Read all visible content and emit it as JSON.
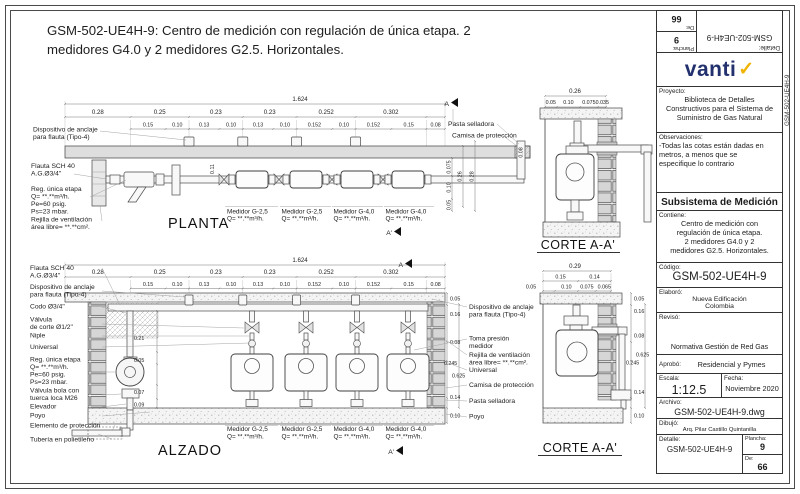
{
  "title": "GSM-502-UE4H-9: Centro de medición con regulación de única etapa.  2 medidores G4.0 y 2 medidores G2.5. Horizontales.",
  "margin_code": "GSM-502-UE4H-9",
  "brand": {
    "name": "vanti",
    "check": "✓",
    "navy": "#22306e",
    "yellow": "#f0b400"
  },
  "tb": {
    "proyecto_label": "Proyecto:",
    "proyecto": "Biblioteca de Detalles\nConstructivos para el Sistema de\nSuministro de Gas Natural",
    "observaciones_label": "Observaciones:",
    "observaciones": "-Todas las cotas están dadas en\nmetros, a menos que se\nespecifique lo contrario",
    "subsistema": "Subsistema de Medición",
    "contiene_label": "Contiene:",
    "contiene": "Centro de medición con\nregulación de única etapa.\n2 medidores G4.0 y 2\nmedidores G2.5. Horizontales.",
    "codigo_label": "Código:",
    "codigo": "GSM-502-UE4H-9",
    "elaboro_label": "Elaboró:",
    "elaboro": "Nueva Edificación\nColombia",
    "reviso_label": "Revisó:",
    "reviso": "Normativa Gestión de Red Gas",
    "aprobo_label": "Aprobó:",
    "aprobo": "Residencial y Pymes",
    "escala_label": "Escala:",
    "escala": "1:12.5",
    "fecha_label": "Fecha:",
    "fecha": "Noviembre 2020",
    "archivo_label": "Archivo:",
    "archivo": "GSM-502-UE4H-9.dwg",
    "dibujo_label": "Dibujó:",
    "dibujo": "Arq. Pilar Castillo Quintanilla",
    "detalle_label": "Detalle:",
    "detalle": "GSM-502-UE4H-9",
    "plancha_label": "Plancha:",
    "plancha": "9",
    "de_label": "De:",
    "de": "66"
  },
  "dims": {
    "overall": "1.624",
    "row1": [
      "0.28",
      "0.25",
      "0.23",
      "0.23",
      "0.252",
      "0.302"
    ],
    "row2": [
      "0.15",
      "0.10",
      "0.13",
      "0.10",
      "0.13",
      "0.10",
      "0.152",
      "0.10",
      "0.152",
      "0.15",
      "0.08"
    ]
  },
  "markers": {
    "a": "A",
    "a2": "A'"
  },
  "meters": {
    "g25": "Medidor G-2,5",
    "g40": "Medidor G-4,0",
    "q": "Q= **.**m³/h."
  },
  "planta": {
    "name": "PLANTA",
    "left": [
      "Dispositivo de anclaje",
      "para flauta (Tipo-4)",
      "Flauta SCH 40",
      "A.G.Ø3/4\"",
      "Reg. única etapa",
      "Q= **.**m³/h.",
      "Pe=60 psig.",
      "Ps=23 mbar.",
      "Rejilla de ventilación",
      "área libre= **.**cm²."
    ],
    "right": [
      "Pasta selladora",
      "Camisa de protección"
    ],
    "side": [
      "0.075",
      "0.10",
      "0.05",
      "0.26",
      "0.28"
    ],
    "wall_dim": "0.08",
    "inner_dim": "0.11"
  },
  "alzado": {
    "name": "ALZADO",
    "left": [
      "Flauta SCH 40",
      "A.G.Ø3/4\"",
      "Dispositivo de anclaje",
      "para flauta (Tipo-4)",
      "Codo Ø3/4\"",
      "Válvula",
      "de corte Ø1/2\"",
      "Niple",
      "Universal",
      "Reg. única etapa",
      "Q= **.**m³/h.",
      "Pe=60 psig.",
      "Ps=23 mbar.",
      "Válvula bola con",
      "tuerca loca M26",
      "Elevador",
      "Poyo",
      "Elemento de protección",
      "Tubería en polietileno"
    ],
    "right": [
      "Dispositivo de anclaje",
      "para flauta (Tipo-4)",
      "Toma presión",
      "medidor",
      "Rejilla de ventilación",
      "área libre= **.**cm².",
      "Universal",
      "Camisa de protección",
      "Pasta selladora",
      "Poyo"
    ],
    "rdims": [
      "0.05",
      "0.16",
      "0.08",
      "0.245",
      "0.625",
      "0.14",
      "0.10"
    ],
    "inner": [
      "0.21",
      "0.05",
      "0.07",
      "0.09"
    ]
  },
  "corte1": {
    "name": "CORTE A-A'",
    "overall": "0.26",
    "row": [
      "0.05",
      "0.10",
      "0.075",
      "0.035"
    ]
  },
  "corte2": {
    "name": "CORTE A-A'",
    "overall": "0.29",
    "rowa": [
      "0.15",
      "0.14"
    ],
    "rowb": [
      "0.05",
      "0.10",
      "0.075",
      "0.065"
    ],
    "rdims": [
      "0.05",
      "0.16",
      "0.08",
      "0.625",
      "0.245",
      "0.14",
      "0.10"
    ]
  }
}
